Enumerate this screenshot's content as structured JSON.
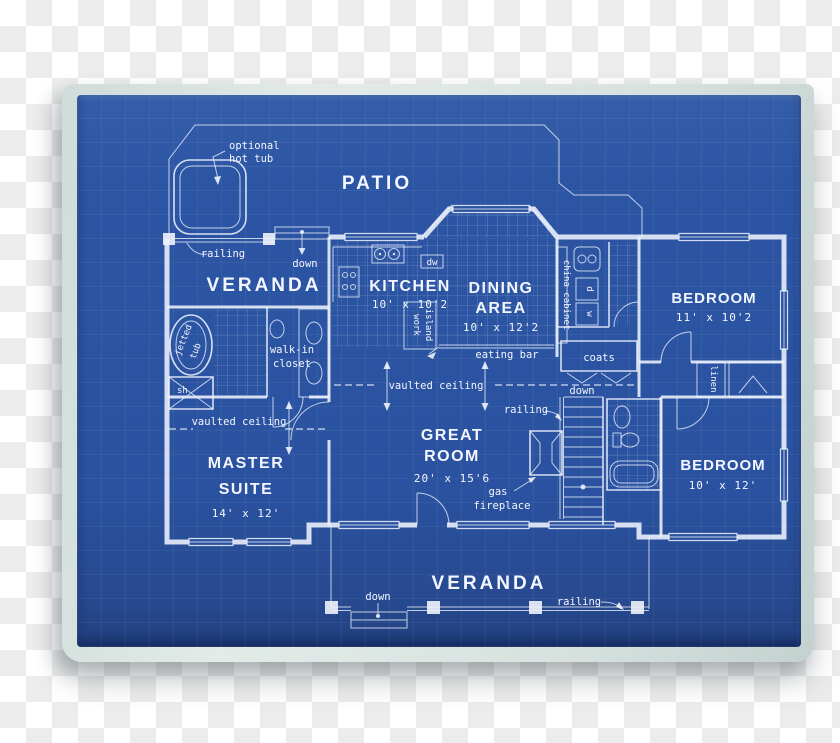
{
  "labels": {
    "patio": "PATIO",
    "hot_tub_1": "optional",
    "hot_tub_2": "hot tub",
    "railing_top": "railing",
    "down_top": "down",
    "veranda_top": "VERANDA",
    "kitchen": "KITCHEN",
    "kitchen_dims": "10' x 10'2",
    "dw": "dw",
    "work": "work",
    "island": "island",
    "eating_bar": "eating bar",
    "dining_1": "DINING",
    "dining_2": "AREA",
    "dining_dims": "10' x 12'2",
    "china_cabinet": "china cabinet",
    "bedroom_1": "BEDROOM",
    "bedroom_1_dims": "11' x 10'2",
    "coats": "coats",
    "linen": "linen",
    "dryer": "d",
    "washer": "w",
    "vaulted_great": "vaulted ceiling",
    "vaulted_master": "vaulted ceiling",
    "down_stairs": "down",
    "railing_stairs": "railing",
    "great_1": "GREAT",
    "great_2": "ROOM",
    "great_dims": "20' x 15'6",
    "gas_1": "gas",
    "gas_2": "fireplace",
    "master_1": "MASTER",
    "master_2": "SUITE",
    "master_dims": "14' x 12'",
    "walk_in_1": "walk-in",
    "walk_in_2": "closet",
    "jetted_1": "jetted",
    "jetted_2": "tub",
    "shower": "sh",
    "bedroom_2": "BEDROOM",
    "bedroom_2_dims": "10' x 12'",
    "veranda_bottom": "VERANDA",
    "down_bottom": "down",
    "railing_bottom": "railing"
  },
  "colors": {
    "blueprint_blue": "#2a52a0",
    "paper_edge": "#d7e2df",
    "line_white": "#eef3fd",
    "checker_gray": "#ececec"
  }
}
